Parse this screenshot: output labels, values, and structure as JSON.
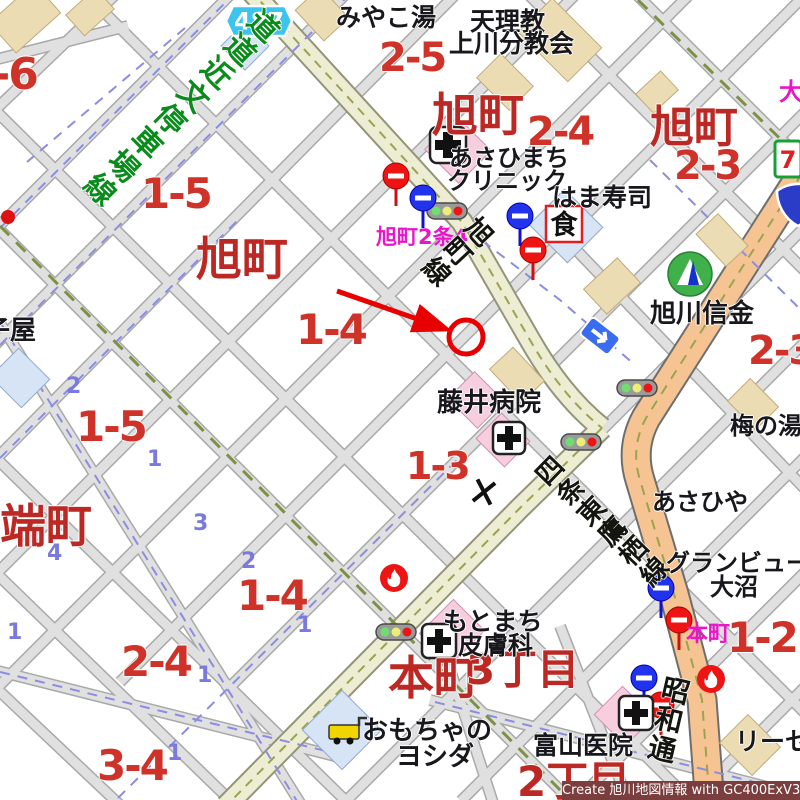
{
  "map": {
    "title_watermark": "Create 旭川地図情報 with GC400ExV3",
    "route_badge": {
      "number": "487"
    },
    "restaurant_badge": {
      "text": "食"
    },
    "seven_eleven_badge": {
      "text": "7"
    },
    "colors": {
      "block_number_red": "#cf3229",
      "district_red": "#bc2823",
      "intersection_magenta": "#e816c8",
      "lot_number_blue": "#7a7ade",
      "road_name_green": "#0a8c1c",
      "minor_road": "#e0e0e0",
      "pref_road_fill": "#ecedd2",
      "main_road_orange": "#f6c493",
      "marker_red": "#e80000",
      "watermark_bg": "#7a3e3e"
    },
    "labels": [
      {
        "text": "-6",
        "x": -8,
        "y": 53,
        "s": 44,
        "cls": "red-num",
        "name": "block-label"
      },
      {
        "text": "1-5",
        "x": 141,
        "y": 173,
        "s": 42,
        "cls": "red-num",
        "name": "block-label"
      },
      {
        "text": "2-5",
        "x": 379,
        "y": 38,
        "s": 40,
        "cls": "red-num",
        "name": "block-label"
      },
      {
        "text": "2-4",
        "x": 527,
        "y": 112,
        "s": 40,
        "cls": "red-num",
        "name": "block-label"
      },
      {
        "text": "2-3",
        "x": 674,
        "y": 146,
        "s": 40,
        "cls": "red-num",
        "name": "block-label"
      },
      {
        "text": "1-4",
        "x": 296,
        "y": 309,
        "s": 42,
        "cls": "red-num",
        "name": "block-label"
      },
      {
        "text": "1-5",
        "x": 76,
        "y": 406,
        "s": 42,
        "cls": "red-num",
        "name": "block-label"
      },
      {
        "text": "1-3",
        "x": 406,
        "y": 447,
        "s": 38,
        "cls": "red-num",
        "name": "block-label"
      },
      {
        "text": "2-3",
        "x": 748,
        "y": 331,
        "s": 40,
        "cls": "red-num",
        "name": "block-label"
      },
      {
        "text": "1-4",
        "x": 237,
        "y": 575,
        "s": 42,
        "cls": "red-num",
        "name": "block-label"
      },
      {
        "text": "2-4",
        "x": 121,
        "y": 641,
        "s": 42,
        "cls": "red-num",
        "name": "block-label"
      },
      {
        "text": "3-4",
        "x": 97,
        "y": 745,
        "s": 42,
        "cls": "red-num",
        "name": "block-label"
      },
      {
        "text": "1-2",
        "x": 727,
        "y": 617,
        "s": 42,
        "cls": "red-num",
        "name": "block-label"
      },
      {
        "text": "旭町",
        "x": 432,
        "y": 92,
        "s": 46,
        "cls": "red-town",
        "name": "district-label"
      },
      {
        "text": "旭町",
        "x": 650,
        "y": 106,
        "s": 44,
        "cls": "red-town",
        "name": "district-label"
      },
      {
        "text": "旭町",
        "x": 196,
        "y": 236,
        "s": 46,
        "cls": "red-town",
        "name": "district-label"
      },
      {
        "text": "端町",
        "x": 0,
        "y": 503,
        "s": 46,
        "cls": "red-town",
        "name": "district-label"
      },
      {
        "text": "本町",
        "x": 388,
        "y": 655,
        "s": 46,
        "cls": "red-town",
        "name": "district-label"
      },
      {
        "text": "3丁目",
        "x": 466,
        "y": 649,
        "s": 42,
        "cls": "red-town",
        "name": "district-label"
      },
      {
        "text": "2丁目",
        "x": 517,
        "y": 761,
        "s": 42,
        "cls": "red-town",
        "name": "district-label"
      },
      {
        "text": "旭町2条4",
        "x": 376,
        "y": 227,
        "s": 21,
        "cls": "mag",
        "name": "intersection-label"
      },
      {
        "text": "本町",
        "x": 686,
        "y": 624,
        "s": 22,
        "cls": "mag",
        "name": "intersection-label"
      },
      {
        "text": "大",
        "x": 779,
        "y": 80,
        "s": 24,
        "cls": "mag",
        "name": "intersection-label"
      },
      {
        "text": "2",
        "x": 66,
        "y": 376,
        "s": 22,
        "cls": "blue-num",
        "name": "lot-number"
      },
      {
        "text": "1",
        "x": 147,
        "y": 449,
        "s": 22,
        "cls": "blue-num",
        "name": "lot-number"
      },
      {
        "text": "3",
        "x": 193,
        "y": 513,
        "s": 22,
        "cls": "blue-num",
        "name": "lot-number"
      },
      {
        "text": "4",
        "x": 47,
        "y": 543,
        "s": 22,
        "cls": "blue-num",
        "name": "lot-number"
      },
      {
        "text": "1",
        "x": 7,
        "y": 622,
        "s": 22,
        "cls": "blue-num",
        "name": "lot-number"
      },
      {
        "text": "1",
        "x": 197,
        "y": 665,
        "s": 22,
        "cls": "blue-num",
        "name": "lot-number"
      },
      {
        "text": "1",
        "x": 167,
        "y": 743,
        "s": 22,
        "cls": "blue-num",
        "name": "lot-number"
      },
      {
        "text": "2",
        "x": 241,
        "y": 551,
        "s": 22,
        "cls": "blue-num",
        "name": "lot-number"
      },
      {
        "text": "1",
        "x": 297,
        "y": 615,
        "s": 22,
        "cls": "blue-num",
        "name": "lot-number"
      },
      {
        "text": "みやこ湯",
        "x": 336,
        "y": 5,
        "s": 25,
        "cls": "poi",
        "name": "poi-label"
      },
      {
        "text": "天理教",
        "x": 470,
        "y": 9,
        "s": 25,
        "cls": "poi",
        "name": "poi-label"
      },
      {
        "text": "上川分教会",
        "x": 449,
        "y": 31,
        "s": 25,
        "cls": "poi",
        "name": "poi-label"
      },
      {
        "text": "あさひまち",
        "x": 449,
        "y": 146,
        "s": 24,
        "cls": "poi",
        "name": "poi-label"
      },
      {
        "text": "クリニック",
        "x": 447,
        "y": 169,
        "s": 24,
        "cls": "poi",
        "name": "poi-label"
      },
      {
        "text": "はま寿司",
        "x": 552,
        "y": 185,
        "s": 25,
        "cls": "poi",
        "name": "poi-label"
      },
      {
        "text": "旭川信金",
        "x": 650,
        "y": 301,
        "s": 26,
        "cls": "poi",
        "name": "poi-label"
      },
      {
        "text": "梅の湯",
        "x": 730,
        "y": 414,
        "s": 24,
        "cls": "poi",
        "name": "poi-label"
      },
      {
        "text": "あさひや",
        "x": 652,
        "y": 490,
        "s": 24,
        "cls": "poi",
        "name": "poi-label"
      },
      {
        "text": "グランビュー",
        "x": 666,
        "y": 551,
        "s": 24,
        "cls": "poi",
        "name": "poi-label"
      },
      {
        "text": "大沼",
        "x": 710,
        "y": 575,
        "s": 24,
        "cls": "poi",
        "name": "poi-label"
      },
      {
        "text": "リーセ",
        "x": 735,
        "y": 729,
        "s": 25,
        "cls": "poi",
        "name": "poi-label"
      },
      {
        "text": "富山医院",
        "x": 533,
        "y": 733,
        "s": 25,
        "cls": "poi",
        "name": "poi-label"
      },
      {
        "text": "もとまち",
        "x": 443,
        "y": 609,
        "s": 25,
        "cls": "poi",
        "name": "poi-label"
      },
      {
        "text": "皮膚科",
        "x": 458,
        "y": 633,
        "s": 25,
        "cls": "poi",
        "name": "poi-label"
      },
      {
        "text": "おもちゃの",
        "x": 362,
        "y": 718,
        "s": 26,
        "cls": "poi",
        "name": "poi-label"
      },
      {
        "text": "ヨシダ",
        "x": 396,
        "y": 744,
        "s": 26,
        "cls": "poi",
        "name": "poi-label"
      },
      {
        "text": "藤井病院",
        "x": 437,
        "y": 390,
        "s": 26,
        "cls": "poi",
        "name": "poi-label"
      },
      {
        "text": "子屋",
        "x": -16,
        "y": 318,
        "s": 26,
        "cls": "poi",
        "name": "poi-label"
      },
      {
        "text": "道道近文停車場線",
        "x": 257,
        "y": 12,
        "s": 30,
        "cls": "road-g",
        "rot": 45,
        "name": "road-name-label"
      },
      {
        "text": "旭町線",
        "x": 474,
        "y": 220,
        "s": 27,
        "cls": "road-b",
        "rot": 47,
        "name": "road-name-label"
      },
      {
        "text": "四条東鷹栖線",
        "x": 524,
        "y": 463,
        "s": 27,
        "cls": "road-b",
        "rot": -46,
        "name": "road-name-label"
      },
      {
        "text": "昭和通",
        "x": 663,
        "y": 676,
        "s": 28,
        "cls": "road-b",
        "rot": 13,
        "name": "road-name-label"
      }
    ],
    "icons": [
      {
        "name": "traffic-light-icon",
        "x": 447,
        "y": 211
      },
      {
        "name": "traffic-light-icon",
        "x": 619,
        "y": 380
      },
      {
        "name": "traffic-light-icon",
        "x": 563,
        "y": 434
      },
      {
        "name": "traffic-light-icon",
        "x": 377,
        "y": 624
      },
      {
        "name": "no-entry-sign-icon",
        "x": 396,
        "y": 176
      },
      {
        "name": "no-entry-sign-icon",
        "x": 533,
        "y": 250
      },
      {
        "name": "no-entry-sign-icon",
        "x": 679,
        "y": 620
      },
      {
        "name": "no-entry-sign-icon",
        "x": 661,
        "y": 705
      },
      {
        "name": "blue-road-sign-icon",
        "x": 423,
        "y": 198
      },
      {
        "name": "blue-road-sign-icon",
        "x": 520,
        "y": 216
      },
      {
        "name": "blue-road-sign-icon",
        "x": 661,
        "y": 588
      },
      {
        "name": "blue-road-sign-icon",
        "x": 644,
        "y": 678
      },
      {
        "name": "fire-hydrant-icon",
        "x": 394,
        "y": 578
      },
      {
        "name": "fire-hydrant-icon",
        "x": 711,
        "y": 679
      },
      {
        "name": "police-box-x-icon",
        "x": 484,
        "y": 492
      },
      {
        "name": "one-way-arrow-sign-icon",
        "x": 600,
        "y": 336
      },
      {
        "name": "hospital-cross-icon",
        "x": 448,
        "y": 145
      },
      {
        "name": "hospital-cross-icon",
        "x": 509,
        "y": 438
      },
      {
        "name": "hospital-cross-icon",
        "x": 439,
        "y": 641
      },
      {
        "name": "hospital-cross-icon",
        "x": 636,
        "y": 713
      },
      {
        "name": "bank-icon",
        "x": 690,
        "y": 274
      },
      {
        "name": "seven-eleven-icon",
        "x": 788,
        "y": 159
      },
      {
        "name": "route-shield-icon",
        "x": 798,
        "y": 205
      },
      {
        "name": "restaurant-icon",
        "x": 564,
        "y": 224
      },
      {
        "name": "toy-shop-icon",
        "x": 345,
        "y": 733
      },
      {
        "name": "boundary-red-dot-icon",
        "x": 8,
        "y": 217
      },
      {
        "name": "destination-marker",
        "x": 466,
        "y": 337
      },
      {
        "name": "route-badge-487",
        "x": 259,
        "y": 21
      }
    ]
  }
}
